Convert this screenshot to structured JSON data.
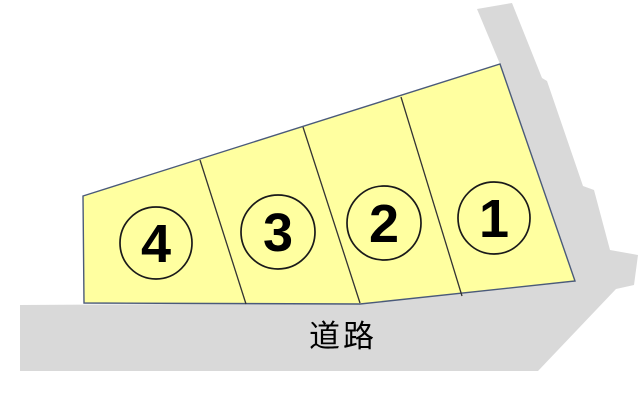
{
  "figure": {
    "title": "land-plot-layout-diagram",
    "road_label": "道路",
    "plots": [
      {
        "id": "plot-1",
        "label": "1"
      },
      {
        "id": "plot-2",
        "label": "2"
      },
      {
        "id": "plot-3",
        "label": "3"
      },
      {
        "id": "plot-4",
        "label": "4"
      }
    ],
    "colors": {
      "plot_fill": "#ffffa0",
      "plot_border": "#4a5a7a",
      "road_fill": "#d9d9d9",
      "divider_line": "#333333",
      "number_text": "#000000",
      "road_text": "#000000",
      "background": "#ffffff"
    }
  }
}
